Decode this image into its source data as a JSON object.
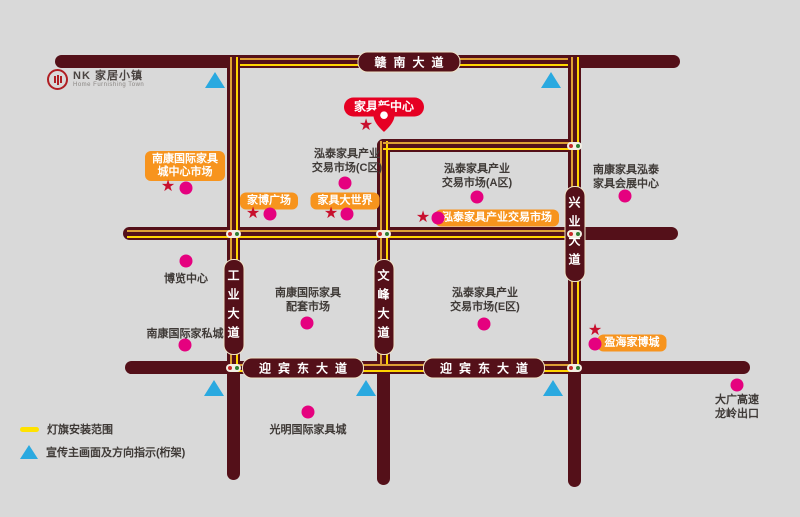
{
  "logo": {
    "brand": "NK 家居小镇",
    "subtitle": "Home Furnishing Town"
  },
  "colors": {
    "background": "#d9d9d9",
    "road": "#541019",
    "flag_yellow": "#ffd400",
    "flag_amber": "#dd9f35",
    "orange_label": "#f7941e",
    "red_label": "#e60023",
    "pink_dot": "#e5017f",
    "star_red": "#c8102e",
    "triangle_blue": "#2aa9e0",
    "text_dark": "#3f3a37"
  },
  "roads": [
    {
      "id": "gannan-avenue",
      "orient": "h",
      "x": 55,
      "y": 55,
      "len": 625,
      "thick": 13,
      "labels": [
        {
          "text": "赣南大道",
          "c": 409
        }
      ]
    },
    {
      "id": "middle-road",
      "orient": "h",
      "x": 123,
      "y": 227,
      "len": 555,
      "thick": 13,
      "labels": []
    },
    {
      "id": "yingbin-east-avenue",
      "orient": "h",
      "x": 125,
      "y": 361,
      "len": 625,
      "thick": 13,
      "labels": [
        {
          "text": "迎宾东大道",
          "c": 303
        },
        {
          "text": "迎宾东大道",
          "c": 484
        }
      ]
    },
    {
      "id": "gongye-avenue",
      "orient": "v",
      "x": 227,
      "y": 55,
      "len": 425,
      "thick": 13,
      "labels": [
        {
          "text": "工业大道",
          "c": 307
        }
      ]
    },
    {
      "id": "wenfeng-avenue",
      "orient": "v",
      "x": 377,
      "y": 139,
      "len": 346,
      "thick": 13,
      "labels": [
        {
          "text": "文峰大道",
          "c": 307
        }
      ]
    },
    {
      "id": "xingye-avenue",
      "orient": "v",
      "x": 568,
      "y": 55,
      "len": 432,
      "thick": 13,
      "labels": [
        {
          "text": "兴业大道",
          "c": 234
        }
      ]
    },
    {
      "id": "inner-link-road",
      "orient": "h",
      "x": 377,
      "y": 139,
      "len": 204,
      "thick": 13,
      "labels": []
    }
  ],
  "flag_lines": [
    {
      "orient": "h",
      "x": 240,
      "y": 57.5,
      "len": 328
    },
    {
      "orient": "h",
      "x": 127,
      "y": 229.5,
      "len": 447
    },
    {
      "orient": "h",
      "x": 233,
      "y": 363.5,
      "len": 341
    },
    {
      "orient": "v",
      "x": 229.5,
      "y": 57,
      "len": 307
    },
    {
      "orient": "v",
      "x": 379.5,
      "y": 141,
      "len": 223
    },
    {
      "orient": "v",
      "x": 570.5,
      "y": 57,
      "len": 307
    },
    {
      "orient": "h",
      "x": 383,
      "y": 141.5,
      "len": 188
    }
  ],
  "junction_signals": [
    {
      "x": 233.5,
      "y": 233.5
    },
    {
      "x": 383.5,
      "y": 233.5
    },
    {
      "x": 574.5,
      "y": 233.5
    },
    {
      "x": 574.5,
      "y": 145.5
    },
    {
      "x": 574.5,
      "y": 367.5
    },
    {
      "x": 233.5,
      "y": 367.5
    }
  ],
  "center_label": {
    "name": "furniture-new-center",
    "text": "家具新中心",
    "cx": 384,
    "cy": 107
  },
  "pin": {
    "cx": 384,
    "cy": 137
  },
  "orange_labels": [
    {
      "name": "nankang-intl-center-market",
      "lines": [
        "南康国际家具",
        "城中心市场"
      ],
      "cx": 185,
      "cy": 166
    },
    {
      "name": "jiabo-plaza",
      "lines": [
        "家博广场"
      ],
      "cx": 269,
      "cy": 201
    },
    {
      "name": "furniture-world",
      "lines": [
        "家具大世界"
      ],
      "cx": 345,
      "cy": 201
    },
    {
      "name": "hongtai-trading-market",
      "lines": [
        "泓泰家具产业交易市场"
      ],
      "cx": 497,
      "cy": 218
    },
    {
      "name": "yinghai-jiabo-city",
      "lines": [
        "盈海家博城"
      ],
      "cx": 632,
      "cy": 343
    }
  ],
  "places": [
    {
      "name": "hongtai-market-c",
      "lines": [
        "泓泰家具产业",
        "交易市场(C区)"
      ],
      "cx": 347,
      "cy": 161
    },
    {
      "name": "hongtai-market-a",
      "lines": [
        "泓泰家具产业",
        "交易市场(A区)"
      ],
      "cx": 477,
      "cy": 176
    },
    {
      "name": "nankang-hongtai-exhibition-center",
      "lines": [
        "南康家具泓泰",
        "家具会展中心"
      ],
      "cx": 626,
      "cy": 177
    },
    {
      "name": "expo-center",
      "lines": [
        "博览中心"
      ],
      "cx": 186,
      "cy": 279
    },
    {
      "name": "nankang-intl-supporting-market",
      "lines": [
        "南康国际家具",
        "配套市场"
      ],
      "cx": 308,
      "cy": 300
    },
    {
      "name": "hongtai-market-e",
      "lines": [
        "泓泰家具产业",
        "交易市场(E区)"
      ],
      "cx": 485,
      "cy": 300
    },
    {
      "name": "nankang-intl-private-furniture-city",
      "lines": [
        "南康国际家私城"
      ],
      "cx": 185,
      "cy": 334
    },
    {
      "name": "guangming-intl-furniture-city",
      "lines": [
        "光明国际家具城"
      ],
      "cx": 308,
      "cy": 430
    },
    {
      "name": "daguang-expressway-longling-exit",
      "lines": [
        "大广高速",
        "龙岭出口"
      ],
      "cx": 737,
      "cy": 407
    }
  ],
  "stars": [
    {
      "x": 168,
      "y": 187
    },
    {
      "x": 253,
      "y": 214
    },
    {
      "x": 331,
      "y": 214
    },
    {
      "x": 423,
      "y": 218
    },
    {
      "x": 595,
      "y": 331
    },
    {
      "x": 366,
      "y": 126
    }
  ],
  "dots": [
    {
      "x": 186,
      "y": 188
    },
    {
      "x": 270,
      "y": 214
    },
    {
      "x": 347,
      "y": 214
    },
    {
      "x": 438,
      "y": 218
    },
    {
      "x": 595,
      "y": 344
    },
    {
      "x": 345,
      "y": 183
    },
    {
      "x": 477,
      "y": 197
    },
    {
      "x": 625,
      "y": 196
    },
    {
      "x": 186,
      "y": 261
    },
    {
      "x": 307,
      "y": 323
    },
    {
      "x": 484,
      "y": 324
    },
    {
      "x": 185,
      "y": 345
    },
    {
      "x": 308,
      "y": 412
    },
    {
      "x": 737,
      "y": 385
    }
  ],
  "triangles": [
    {
      "x": 215,
      "y": 80
    },
    {
      "x": 551,
      "y": 80
    },
    {
      "x": 214,
      "y": 388
    },
    {
      "x": 366,
      "y": 388
    },
    {
      "x": 553,
      "y": 388
    }
  ],
  "legend": {
    "items": [
      {
        "label": "灯旗安装范围"
      },
      {
        "label": "宣传主画面及方向指示(桁架)"
      }
    ]
  }
}
